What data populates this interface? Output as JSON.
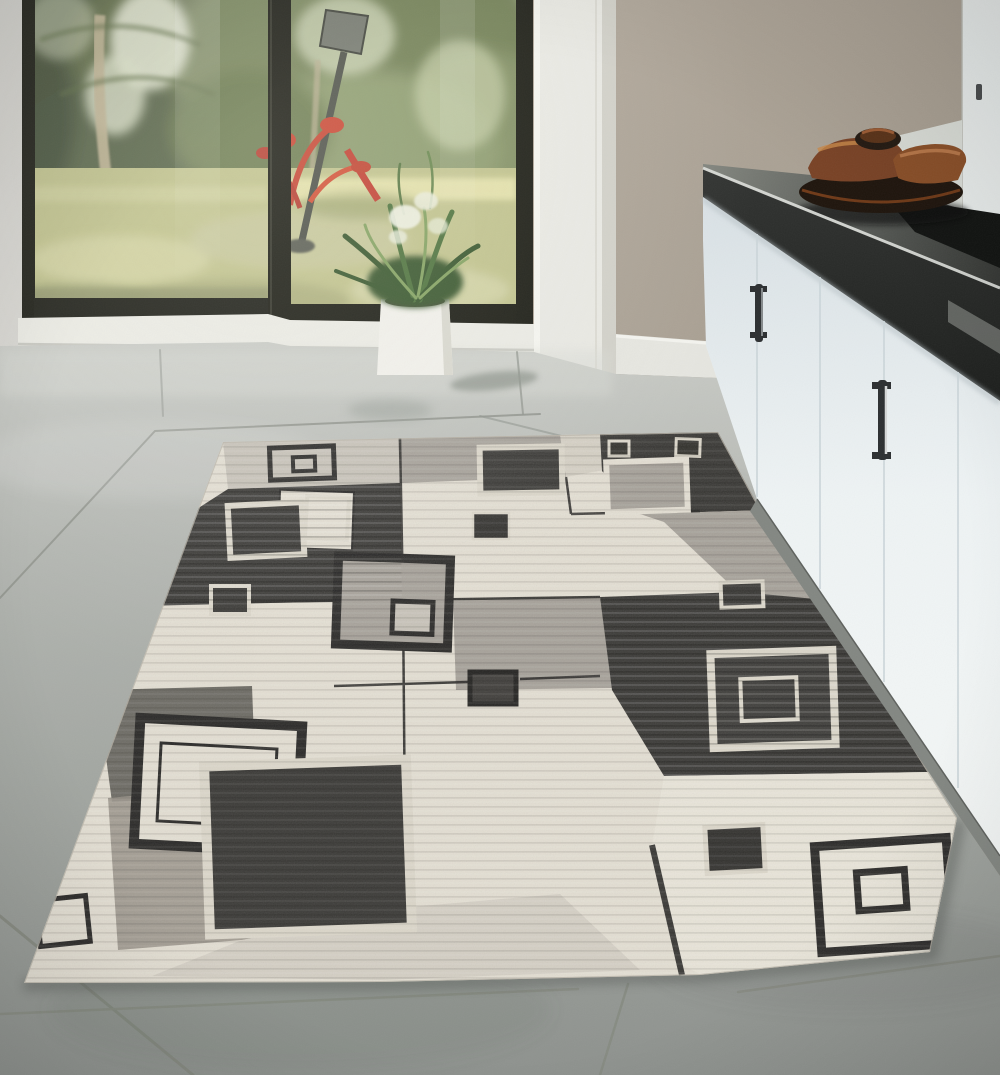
{
  "meta": {
    "description": "Product photo: modern geometric area rug in gray, charcoal and cream laid on large gray floor tiles in a bright kitchen with white cabinets, dark countertop, wooden decor bowl, potted fern in a white planter, and floor-to-ceiling glass doors looking onto a sunny garden with a lamp post and a red tropical plant."
  },
  "palette": {
    "wall": "#b1a89b",
    "wall-dark": "#a49b8e",
    "trim": "#e9e9e3",
    "trim-shade": "#d2d1c9",
    "strip-light": "#d8d7d2",
    "frame-dark": "#1d1e16",
    "frame-mid": "#34352b",
    "sill": "#ebebe4",
    "sky": "#e3e7cf",
    "foliage-dark": "#4a583c",
    "foliage-mid": "#6d7c50",
    "foliage-light": "#97a56d",
    "lawn": "#bec088",
    "lawn-light": "#ddd9a4",
    "lawn-dark": "#8e9368",
    "trunk": "#c2b694",
    "lamp": "#70746a",
    "lamp-dark": "#474a42",
    "red": "#c5402d",
    "paving": "#b5b5a9",
    "planter": "#f1f0ea",
    "planter-shade": "#d9d8cf",
    "fern-dark": "#3c5a31",
    "fern-mid": "#517540",
    "fern-light": "#85a363",
    "blossom": "#eef0e2",
    "counter-back": "#83867f",
    "counter-front": "#1d1f1d",
    "counter-bevel": "#d9dbd6",
    "sink": "#121412",
    "bowl-dark": "#1f150d",
    "wood": "#7a4326",
    "wood-light": "#c08050",
    "cabinet-top": "#d9e1e5",
    "cabinet-bottom": "#f4f7f6",
    "cabinet-seam": "#ccd6da",
    "handle": "#2c2f31",
    "toe-kick": "#838782",
    "floor-top": "#c9cbc6",
    "floor-bottom": "#8e928e",
    "grout": "#90948d",
    "rug-cream": "#e4dfd3",
    "rug-bright": "#e9e5d9",
    "rug-light": "#c8c3b9",
    "rug-pale": "#d5d0c4",
    "rug-mid": "#a7a29a",
    "rug-warm": "#9c978d",
    "rug-charcoal": "#3b3a37",
    "rug-line": "#2c2b29",
    "rug-pale-border": "#dcd7ca",
    "shadow": "#545854"
  },
  "scene": {
    "room": "kitchen with garden view",
    "lighting": "bright daylight through floor-to-ceiling glass",
    "objects": [
      {
        "name": "sliding-glass-door",
        "desc": "dark framed floor-to-ceiling glass panels"
      },
      {
        "name": "garden-view",
        "desc": "palms, hedges, sunlit lawn"
      },
      {
        "name": "lamp-post",
        "desc": "dark outdoor lamp leaning in garden"
      },
      {
        "name": "red-plant",
        "desc": "red tropical stems and blooms"
      },
      {
        "name": "potted-fern",
        "desc": "green fern with white blooms in white cube planter"
      },
      {
        "name": "door-trim",
        "desc": "white door casing and baseboard"
      },
      {
        "name": "kitchen-cabinets",
        "desc": "white panel cabinets with dark bar handles"
      },
      {
        "name": "countertop",
        "desc": "dark gray counter with sink"
      },
      {
        "name": "decor-bowl",
        "desc": "dark wooden platter with carved wood pieces"
      },
      {
        "name": "tile-floor",
        "desc": "large gray porcelain tiles"
      },
      {
        "name": "area-rug",
        "desc": "geometric squares rug in cream, gray and charcoal"
      }
    ],
    "rug_pattern": {
      "style": "overlapping concentric squares on patchwork fields",
      "colors": [
        "cream",
        "light gray",
        "medium gray",
        "charcoal"
      ],
      "motif_count": 16
    }
  }
}
